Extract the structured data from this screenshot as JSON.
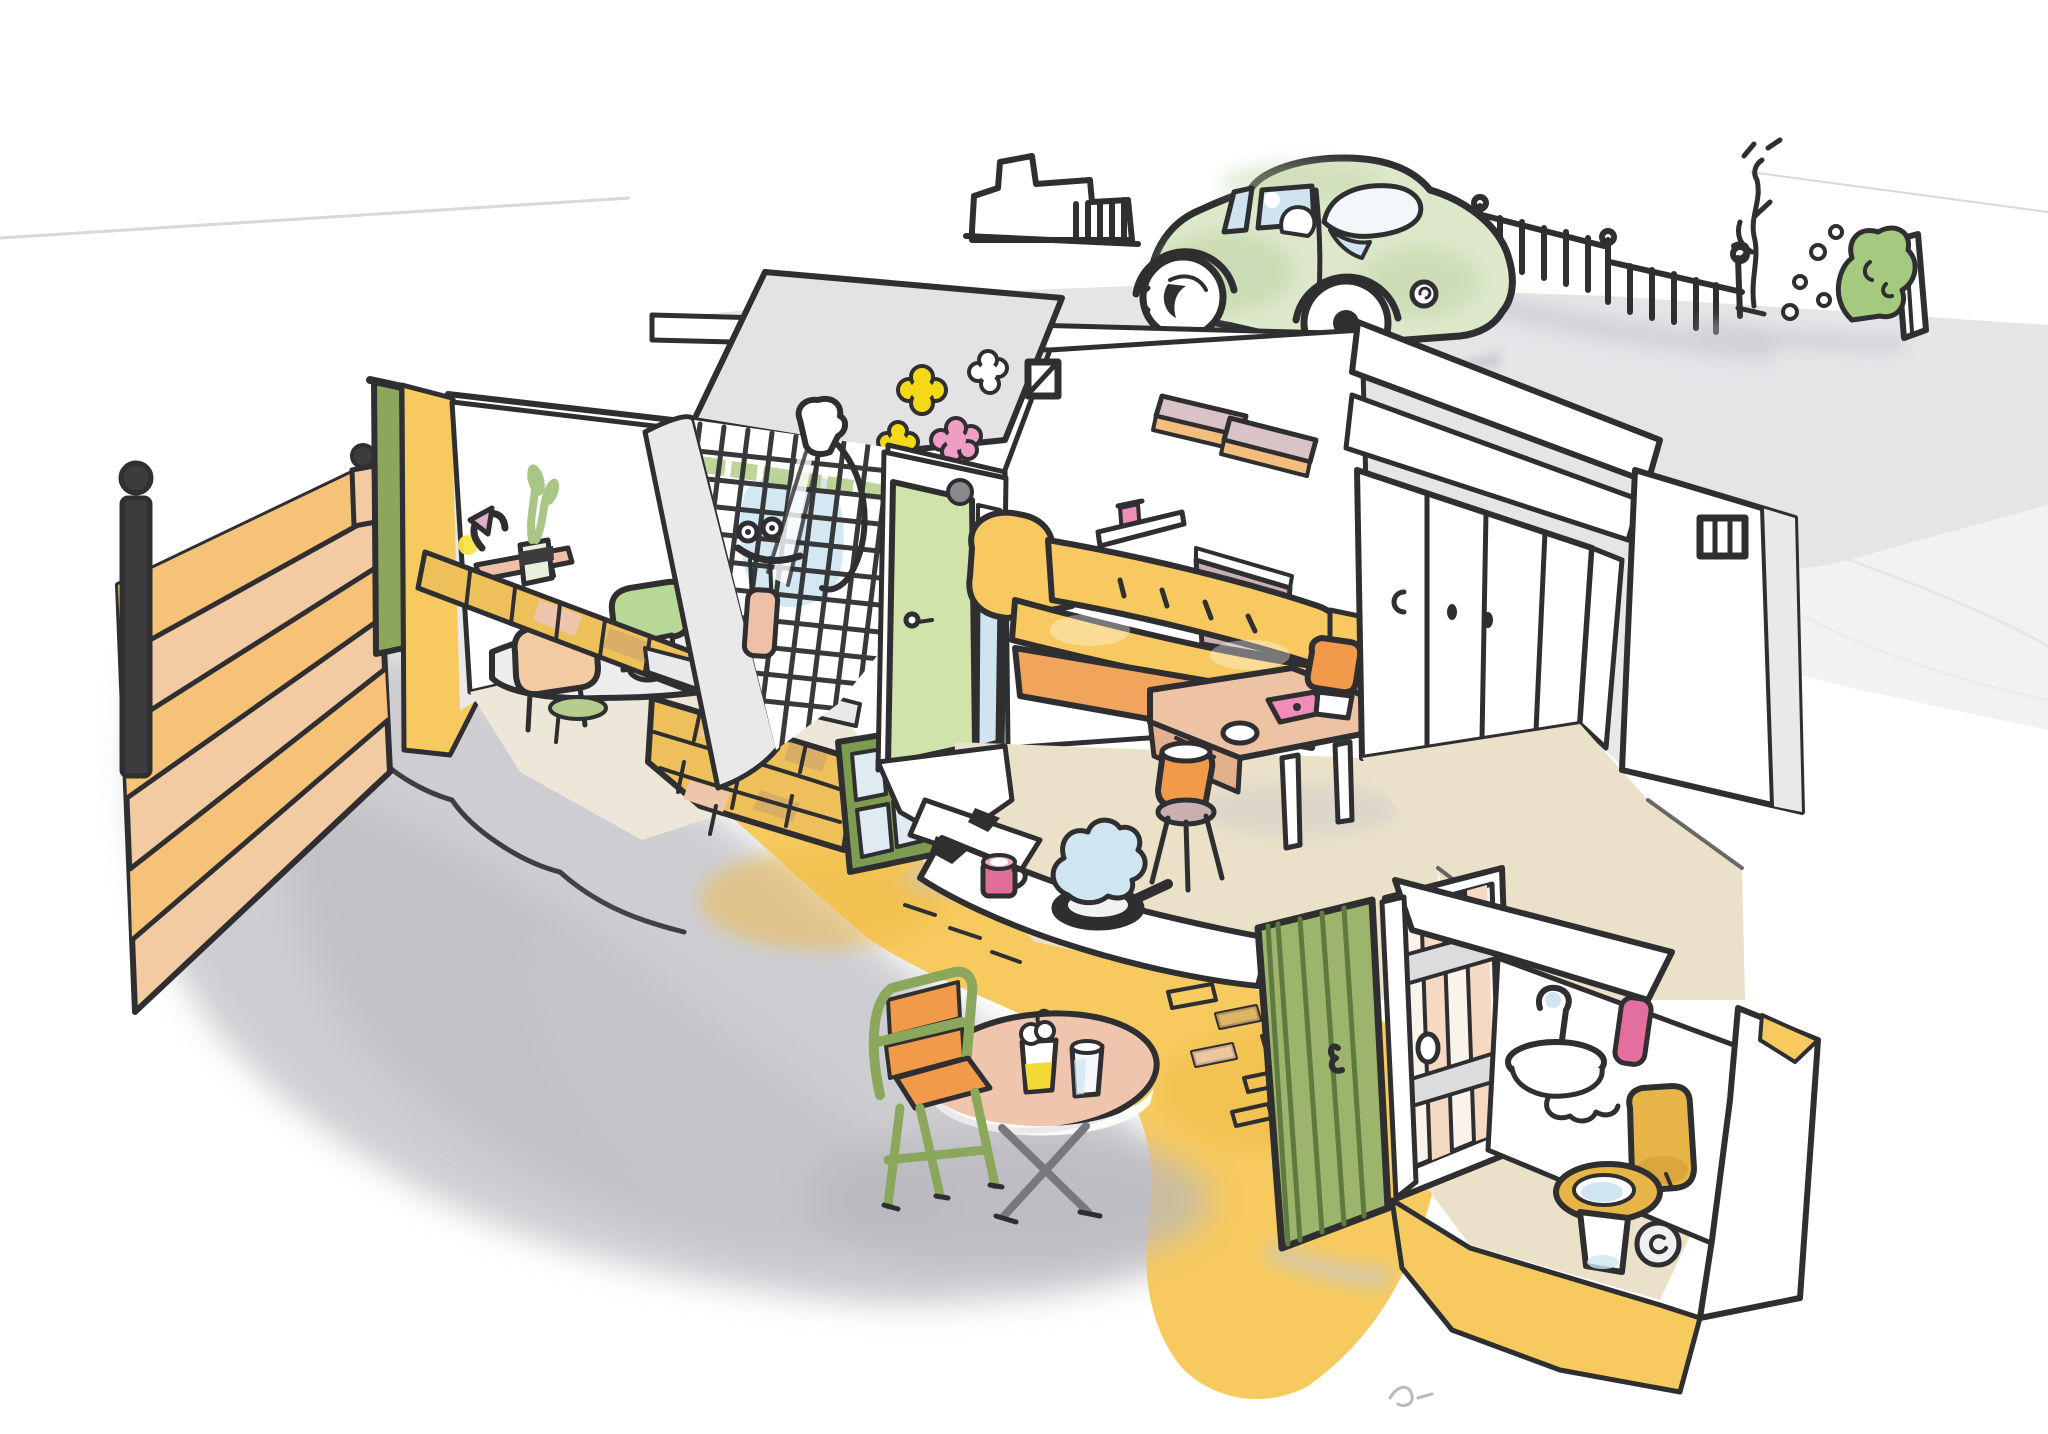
{
  "scene": {
    "medium": "ink and watercolour sketch",
    "subject": "Cutaway illustration of a small terraced house with street, interior rooms, back yard and outside toilet",
    "areas": {
      "street": [
        "road",
        "pavement",
        "small-green-car",
        "garden-wall",
        "railings",
        "tree",
        "bush",
        "gate"
      ],
      "garden": [
        "timber-fence",
        "fence-posts",
        "corner-post",
        "yellow-brick-path",
        "ground-shadow",
        "patio-chair",
        "patio-table",
        "beer-glass",
        "milk-glass"
      ],
      "study": [
        "wall-shelf",
        "desk-lamp",
        "potted-plant",
        "desk",
        "desk-chairs",
        "cup",
        "pink-bowl",
        "notepad",
        "green-rug"
      ],
      "shower-room": [
        "tiled-wall",
        "shower-head",
        "shower-hose",
        "mixer-taps",
        "water-spray",
        "peach-towel"
      ],
      "living-room": [
        "flower-decals",
        "air-vent",
        "green-interior-door",
        "glazed-side-panel",
        "yellow-sofa",
        "wall-shelves",
        "picture-shelf",
        "mauve-half-wall"
      ],
      "dining-area": [
        "salmon-table",
        "pink-placemat",
        "white-bowl",
        "orange-chairs"
      ],
      "hallway": [
        "cupboard-doors",
        "door-handles"
      ],
      "kitchen": [
        "cut-wall-counter",
        "pink-mug",
        "saucepan",
        "steam-cloud"
      ],
      "outside-toilet": [
        "plank-door",
        "wash-basin",
        "curly-tap",
        "pink-towel",
        "toilet-open-lid",
        "toilet-paper-roll"
      ],
      "cutaway": [
        "exposed-brick-wall",
        "leaning-casement-window",
        "green-yard-door",
        "boundary-wall",
        "vent-window"
      ]
    }
  },
  "palette": {
    "ink": "#2f2f31",
    "paper": "#ffffff",
    "road": "#e5e5e8",
    "pavement": "#efeff1",
    "shadow": "#c6c6cb",
    "shadow_dark": "#b7b7bd",
    "car_body": "#dde8cb",
    "car_shade": "#bcd4a4",
    "glass_blue": "#cfe4f0",
    "fence_peach": "#f3cba3",
    "fence_orange": "#f5c278",
    "post_dark": "#3c3c3e",
    "post_green": "#8ba75b",
    "wall_yellow": "#f6ca5f",
    "wall_yellow_deep": "#eeb944",
    "brick_yellow": "#eec05a",
    "brick_tan": "#d8ae67",
    "brick_pink": "#eec6ad",
    "plaster_gray": "#e9e9eb",
    "floor_beige": "#eae1c8",
    "floor_pale": "#ece7d9",
    "gable_gray": "#e3e3e6",
    "tile_green": "#b7cf8e",
    "steam_blue": "#cfe6f2",
    "leaf_green": "#a9c687",
    "bush_green": "#a5c97e",
    "lamp_yellow": "#f6e34a",
    "lamp_shade": "#dcb0cc",
    "bowl_pink": "#d895a8",
    "pad_green": "#b5cc8e",
    "chair_green": "#b8d896",
    "door_pale_green": "#cfe3ab",
    "door_sage": "#9cb46c",
    "door_sage_dark": "#5f7a3f",
    "frame_green": "#7d9c4f",
    "sofa_yellow": "#f8c960",
    "sofa_orange": "#f0a45c",
    "shelf_orange": "#f3bd7e",
    "shelf_mauve": "#d9c3c6",
    "mauve": "#c9afb2",
    "table_salmon": "#edc3a4",
    "table_salmon_dark": "#e2b18c",
    "chair_orange": "#f09a4a",
    "pink_mat": "#ef8cb8",
    "mug_pink": "#e06e98",
    "towel_pink": "#e26f9e",
    "towel_peach": "#eec0a8",
    "toilet_mustard": "#e7b448",
    "patio_table": "#efc5ae",
    "metal_gray": "#77777c",
    "beer_yellow": "#f2d937",
    "flower_yellow": "#f5d816",
    "flower_pink": "#ee9ec4",
    "paper_line": "#d9d9dc"
  }
}
